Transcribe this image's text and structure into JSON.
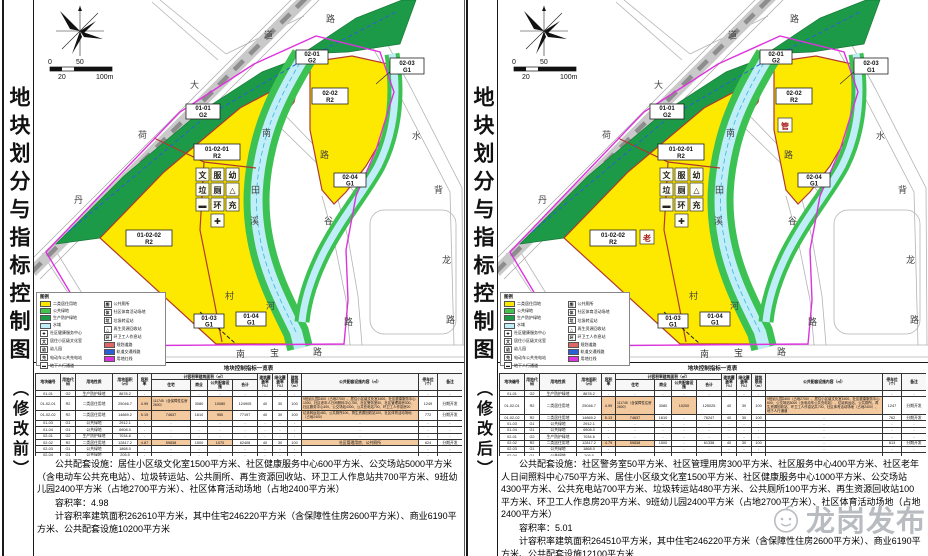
{
  "watermark": {
    "label": "龙岗发布",
    "logo": "longgang-mascot-icon"
  },
  "shared": {
    "scale_bar": {
      "n0": "0",
      "n50": "50",
      "n20": "20",
      "n100": "100m"
    },
    "map": {
      "roads": {
        "rail": [
          "丹",
          "荷",
          "大",
          "道"
        ],
        "top": "路",
        "mid": [
          "南",
          "路"
        ],
        "river": [
          "田",
          "溪",
          "河"
        ],
        "village": "村",
        "valley": [
          "谷",
          "路"
        ],
        "right": [
          "水",
          "背",
          "龙",
          "路"
        ],
        "south": [
          "南",
          "宝",
          "路"
        ]
      },
      "parcels": {
        "p0101": {
          "l1": "01-01",
          "l2": "G2"
        },
        "p010201": {
          "l1": "01-02-01",
          "l2": "R2"
        },
        "p010202": {
          "l1": "01-02-02",
          "l2": "R2"
        },
        "p0103": {
          "l1": "01-03",
          "l2": "G1"
        },
        "p0104": {
          "l1": "01-04",
          "l2": "G1"
        },
        "p0201": {
          "l1": "02-01",
          "l2": "G2"
        },
        "p0202": {
          "l1": "02-02",
          "l2": "R2"
        },
        "p0203": {
          "l1": "02-03",
          "l2": "G1"
        },
        "p0204": {
          "l1": "02-04",
          "l2": "G1"
        }
      },
      "facility_icons": [
        {
          "g": "文",
          "name": "culture-room-icon"
        },
        {
          "g": "服",
          "name": "community-service-icon"
        },
        {
          "g": "幼",
          "name": "kindergarten-icon"
        },
        {
          "g": "垃",
          "name": "waste-transfer-icon"
        },
        {
          "g": "厕",
          "name": "public-toilet-icon"
        },
        {
          "g": "△",
          "name": "recycling-station-icon"
        },
        {
          "g": "▬",
          "name": "underpass-icon"
        },
        {
          "g": "环",
          "name": "sanitation-rest-icon"
        },
        {
          "g": "充",
          "name": "charging-station-icon"
        },
        {
          "g": "✚",
          "name": "health-center-icon"
        }
      ]
    },
    "legend": {
      "title": "图例",
      "left": [
        {
          "swatch": "#fde900",
          "label": "二类居住用地"
        },
        {
          "swatch": "#44c24e",
          "label": "公共绿地"
        },
        {
          "swatch": "#1d9a47",
          "label": "生产防护绿地"
        },
        {
          "swatch": "#bfeef8",
          "label": "水域"
        },
        {
          "icon": "✚",
          "label": "社区健康服务中心"
        },
        {
          "icon": "文",
          "label": "居住小区级文化室"
        },
        {
          "icon": "幼",
          "label": "幼儿园"
        },
        {
          "icon": "充",
          "label": "电动车公共充电站"
        },
        {
          "icon": "▬",
          "label": "地下人行通道"
        }
      ],
      "right": [
        {
          "icon": "厕",
          "label": "公共厕所"
        },
        {
          "icon": "体",
          "label": "社区体育活动场地"
        },
        {
          "icon": "垃",
          "label": "垃圾转运站"
        },
        {
          "icon": "△",
          "label": "再生资源回收站"
        },
        {
          "icon": "环",
          "label": "环卫工人作息站"
        },
        {
          "swatch": "#e06666",
          "label": "规划道路"
        },
        {
          "swatch": "#2b5fd9",
          "label": "轨道交通线路"
        },
        {
          "swatch": "#dd33dd",
          "label": "用地红线"
        }
      ]
    },
    "table": {
      "title": "地块控制指标一览表",
      "header_row1": [
        {
          "t": "地块编号",
          "rs": 2
        },
        {
          "t": "用地代码",
          "rs": 2
        },
        {
          "t": "用地性质",
          "rs": 2
        },
        {
          "t": "用地面积（㎡）",
          "rs": 2
        },
        {
          "t": "容积率",
          "rs": 2
        },
        {
          "t": "计容积率建筑面积（㎡）",
          "cs": 4
        },
        {
          "t": "建筑覆盖率（%）",
          "rs": 2
        },
        {
          "t": "绿化覆盖率（%）",
          "rs": 2
        },
        {
          "t": "建筑限高（m）",
          "rs": 2
        },
        {
          "t": "公共配套设施内容（㎡）",
          "rs": 2
        },
        {
          "t": "停车位（个）",
          "rs": 2
        },
        {
          "t": "备注",
          "rs": 2
        }
      ],
      "header_row2": [
        "住宅",
        "商业",
        "公共配套设施",
        "合计"
      ]
    }
  },
  "panels": [
    {
      "id": "before",
      "side_title": "地块划分与指标控制图",
      "side_sub": "（修改前）",
      "map": {
        "extra_icons": {
          "elder": "",
          "mgmt": ""
        }
      },
      "table": {
        "rows": [
          {
            "c": [
              "01-01",
              "G2",
              "生产防护绿地",
              "8678.2",
              "-",
              "-",
              "-",
              "-",
              "-",
              "-",
              "-",
              "-",
              "-",
              "-",
              "-"
            ]
          },
          {
            "c": [
              "01-02-01",
              "R2",
              "二类居住用地",
              "25046.7",
              "4.99",
              "111745（含保障性住房2600）",
              "3080",
              "10200",
              "125025",
              "40",
              "30",
              "100",
              "9班幼儿园2400（占地2700）、居住小区级文化室1500、社区健康服务中心600、公交场站5000（含电动车公共充电站）、垃圾转运站、公共厕所、再生资源回收站、环卫工人作息站共700、社区体育活动场地（占地2400）、地下人行通道",
              "1247",
              "分期开发"
            ],
            "hl": [
              4,
              5,
              7,
              12
            ]
          },
          {
            "c": [
              "01-02-02",
              "R2",
              "二类居住用地",
              "14869.2",
              "5.13",
              "74637",
              "1610",
              "-",
              "76247",
              "40",
              "30",
              "100",
              "-",
              "762",
              "分期开发"
            ],
            "hl": [
              4,
              5
            ]
          },
          {
            "c": [
              "01-03",
              "G1",
              "公共绿地",
              "2912.1",
              "-",
              "-",
              "-",
              "-",
              "-",
              "-",
              "-",
              "-",
              "-",
              "-",
              "-"
            ]
          },
          {
            "c": [
              "01-04",
              "G1",
              "公共绿地",
              "6908.0",
              "-",
              "-",
              "-",
              "-",
              "-",
              "-",
              "-",
              "-",
              "-",
              "-",
              "-"
            ]
          },
          {
            "c": [
              "02-01",
              "G2",
              "生产防护绿地",
              "7034.6",
              "-",
              "-",
              "-",
              "-",
              "-",
              "-",
              "-",
              "-",
              "-",
              "-",
              "-"
            ]
          },
          {
            "c": [
              "02-02",
              "R2",
              "二类居住用地",
              "12817.2",
              "4.79",
              "59838",
              "1500",
              "-",
              "61338",
              "40",
              "30",
              "100",
              "-",
              "613",
              "分期开发"
            ],
            "hl": [
              4,
              5
            ]
          },
          {
            "c": [
              "02-03",
              "G1",
              "公共绿地",
              "1868.0",
              "-",
              "-",
              "-",
              "-",
              "-",
              "-",
              "-",
              "-",
              "-",
              "-",
              "-"
            ]
          },
          {
            "c": [
              "02-04",
              "G1",
              "公共绿地",
              "205.5",
              "-",
              "-",
              "-",
              "-",
              "-",
              "-",
              "-",
              "-",
              "-",
              "-",
              "-"
            ]
          },
          {
            "c": [
              "合计",
              "80339.5",
              "4.98",
              "246220",
              "6190",
              "10200",
              "262610",
              "-",
              "-",
              "-",
              "-",
              "2622",
              "-"
            ],
            "cs": 3,
            "hl": [
              2,
              3,
              5,
              6
            ]
          }
        ]
      },
      "notes": {
        "p1": "公共配套设施：居住小区级文化室1500平方米、社区健康服务中心600平方米、公交场站5000平方米（含电动车公共充电站）、垃圾转运站、公共厕所、再生资源回收站、环卫工人作息站共700平方米、9班幼儿园2400平方米（占地2700平方米）、社区体育活动场地（占地2400平方米）",
        "p2": "容积率：4.98",
        "p3": "计容积率建筑面积262610平方米，其中住宅246220平方米（含保障性住房2600平方米）、商业6190平方米、公共配套设施10200平方米"
      }
    },
    {
      "id": "after",
      "side_title": "地块划分与指标控制图",
      "side_sub": "（修改后）",
      "map": {
        "extra_icons": {
          "elder": "老",
          "mgmt": "管"
        }
      },
      "table": {
        "rows": [
          {
            "c": [
              "01-01",
              "G2",
              "生产防护绿地",
              "8678.2",
              "-",
              "-",
              "-",
              "-",
              "-",
              "-",
              "-",
              "-",
              "-",
              "-",
              "-"
            ]
          },
          {
            "c": [
              "01-02-01",
              "R2",
              "二类居住用地",
              "25046.7",
              "4.99",
              "111745（含保障性住房2600）",
              "3080",
              "10080",
              "124905",
              "40",
              "30",
              "100",
              "9班幼儿园2400（占地2700）、居住小区级文化室1500、社区健康服务中心1000、社区老年人日间照料中心750、社区警务室50、社区管理用房300、社区服务中心400、公交场站4300、公共充电站700、环卫工人作息房20",
              "1249",
              "分期开发"
            ],
            "hl": [
              4,
              5,
              7,
              12
            ]
          },
          {
            "c": [
              "01-02-02",
              "R2",
              "二类居住用地",
              "14869.2",
              "5.19",
              "74637",
              "1610",
              "950",
              "77197",
              "40",
              "30",
              "100",
              "垃圾转运站480、公共厕所100、再生资源回收站100、社区体育活动场地（占地2400）",
              "772",
              "分期开发"
            ],
            "hl": [
              4,
              5,
              7,
              12
            ]
          },
          {
            "c": [
              "01-03",
              "G1",
              "公共绿地",
              "2912.1",
              "-",
              "-",
              "-",
              "-",
              "-",
              "-",
              "-",
              "-",
              "-",
              "-",
              "-"
            ]
          },
          {
            "c": [
              "01-04",
              "G1",
              "公共绿地",
              "6908.0",
              "-",
              "-",
              "-",
              "-",
              "-",
              "-",
              "-",
              "-",
              "-",
              "-",
              "-"
            ]
          },
          {
            "c": [
              "02-01",
              "G2",
              "生产防护绿地",
              "7034.6",
              "-",
              "-",
              "-",
              "-",
              "-",
              "-",
              "-",
              "-",
              "-",
              "-",
              "-"
            ]
          },
          {
            "c": [
              "02-02",
              "R2",
              "二类居住用地",
              "12817.2",
              "4.87",
              "59838",
              "1500",
              "1070",
              "62408",
              "40",
              "30",
              "100",
              "社区管理用房、公共厕所",
              "624",
              "分期开发"
            ],
            "hl": [
              4,
              5,
              7,
              12
            ]
          },
          {
            "c": [
              "02-03",
              "G1",
              "公共绿地",
              "1868.0",
              "-",
              "-",
              "-",
              "-",
              "-",
              "-",
              "-",
              "-",
              "-",
              "-",
              "-"
            ]
          },
          {
            "c": [
              "02-04",
              "G1",
              "公共绿地",
              "205.5",
              "-",
              "-",
              "-",
              "-",
              "-",
              "-",
              "-",
              "-",
              "-",
              "-",
              "-"
            ]
          },
          {
            "c": [
              "合计",
              "80339.5",
              "5.01",
              "246220",
              "6190",
              "12100",
              "264510",
              "-",
              "-",
              "-",
              "-",
              "2645",
              "-"
            ],
            "cs": 3,
            "hl": [
              2,
              3,
              5,
              6
            ]
          }
        ]
      },
      "notes": {
        "p1": "公共配套设施：社区警务室50平方米、社区管理用房300平方米、社区服务中心400平方米、社区老年人日间照料中心750平方米、居住小区级文化室1500平方米、社区健康服务中心1000平方米、公交场站4300平方米、公共充电站700平方米、垃圾转运站480平方米、公共厕所100平方米、再生资源回收站100平方米、环卫工人作息房20平方米、9班幼儿园2400平方米（占地2700平方米）、社区体育活动场地（占地2400平方米）",
        "p2": "容积率：5.01",
        "p3": "计容积率建筑面积264510平方米，其中住宅246220平方米（含保障性住房2600平方米）、商业6190平方米、公共配套设施12100平方米"
      }
    }
  ]
}
